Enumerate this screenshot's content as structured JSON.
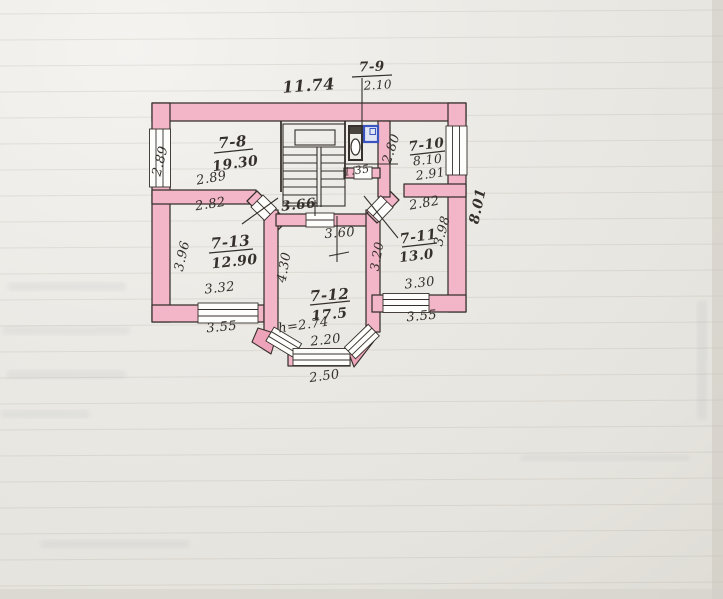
{
  "rooms": {
    "r7_8": {
      "number": "7-8",
      "area": "19.30"
    },
    "r7_9": {
      "number": "7-9",
      "area": "2.10"
    },
    "r7_10": {
      "number": "7-10",
      "area": "8.10",
      "width": "2.91"
    },
    "r7_11": {
      "number": "7-11",
      "area": "13.0"
    },
    "r7_12": {
      "number": "7-12",
      "area": "17.5",
      "ceiling_height": "h=2.74"
    },
    "r7_13": {
      "number": "7-13",
      "area": "12.90"
    }
  },
  "dims": {
    "top_width": "11.74",
    "right_height": "8.01",
    "left_window": "2.89",
    "r78_width": "2.89",
    "r79_width": "1.35",
    "r710_depth": "2.80",
    "r713_top": "2.82",
    "r711_top": "2.82",
    "hall_width": "3.66",
    "r712_top": "3.60",
    "r713_left": "3.96",
    "r711_left": "3.20",
    "r711_right": "3.98",
    "r712_left": "4.30",
    "r713_bottom": "3.32",
    "r713_window": "3.55",
    "r711_bottom": "3.30",
    "r711_window": "3.55",
    "bay_inner": "2.20",
    "bay_outer": "2.50"
  },
  "colors": {
    "wall_fill": "#f3b6c8",
    "wall_fill_deep": "#eda4ba",
    "ink": "#35302b",
    "fixture_blue": "#3a55c0",
    "paper": "#eae8e2"
  }
}
